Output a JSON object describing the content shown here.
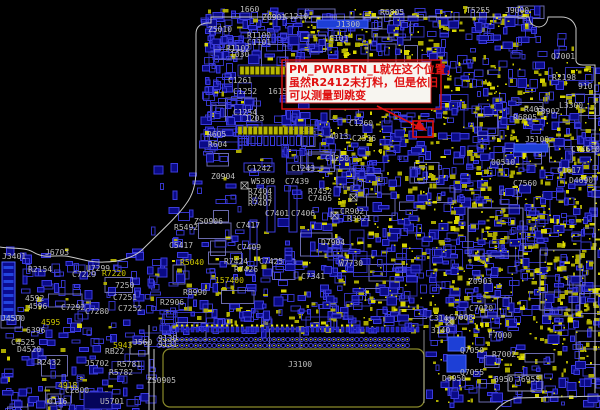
{
  "view": {
    "type": "pcb-boardview",
    "width": 600,
    "height": 410
  },
  "palette": {
    "background": "#000000",
    "blue_outline": "#3b3bdc",
    "blue_fill": "#0a0a85",
    "blue_bright": "#1d3fd6",
    "yellow": "#b9b700",
    "yellow_bright": "#e8e600",
    "label_gray": "#bfbfbf",
    "label_yellow": "#cfc800",
    "board_outline": "#c9c9c9",
    "connector_outline": "#8a8a2a",
    "red": "#e01212",
    "note_bg": "#f7f5f0"
  },
  "annotation": {
    "lines": [
      "PM_PWRBTN_L就在这个位置，",
      "虽然R2412未打料，但是依旧",
      "可以测量到跳变"
    ]
  },
  "labels": [
    {
      "t": "1660",
      "x": 240,
      "y": 12,
      "c": "g"
    },
    {
      "t": "Z0901",
      "x": 262,
      "y": 20,
      "c": "g"
    },
    {
      "t": "C1210",
      "x": 284,
      "y": 19,
      "c": "g"
    },
    {
      "t": "J1300",
      "x": 336,
      "y": 27,
      "c": "g"
    },
    {
      "t": "Z5010",
      "x": 208,
      "y": 32,
      "c": "g"
    },
    {
      "t": "R1100",
      "x": 247,
      "y": 38,
      "c": "g"
    },
    {
      "t": "C1101",
      "x": 247,
      "y": 45,
      "c": "g"
    },
    {
      "t": "R1102",
      "x": 226,
      "y": 51,
      "c": "g"
    },
    {
      "t": "C101",
      "x": 329,
      "y": 41,
      "c": "g"
    },
    {
      "t": "1030",
      "x": 230,
      "y": 57,
      "c": "g"
    },
    {
      "t": "C1261",
      "x": 228,
      "y": 83,
      "c": "g"
    },
    {
      "t": "C1252",
      "x": 233,
      "y": 94,
      "c": "g"
    },
    {
      "t": "1615",
      "x": 268,
      "y": 94,
      "c": "g"
    },
    {
      "t": "C1254",
      "x": 233,
      "y": 115,
      "c": "g"
    },
    {
      "t": "1203",
      "x": 245,
      "y": 121,
      "c": "g"
    },
    {
      "t": "R605",
      "x": 207,
      "y": 137,
      "c": "g"
    },
    {
      "t": "R604",
      "x": 208,
      "y": 147,
      "c": "g"
    },
    {
      "t": "Z0904",
      "x": 211,
      "y": 179,
      "c": "g"
    },
    {
      "t": "C1242",
      "x": 247,
      "y": 171,
      "c": "g"
    },
    {
      "t": "C1243",
      "x": 291,
      "y": 171,
      "c": "g"
    },
    {
      "t": "W5309",
      "x": 251,
      "y": 184,
      "c": "g"
    },
    {
      "t": "C7439",
      "x": 285,
      "y": 184,
      "c": "g"
    },
    {
      "t": "R7404",
      "x": 248,
      "y": 194,
      "c": "g"
    },
    {
      "t": "R7403",
      "x": 248,
      "y": 200,
      "c": "g"
    },
    {
      "t": "R7407",
      "x": 248,
      "y": 206,
      "c": "g"
    },
    {
      "t": "R7452",
      "x": 308,
      "y": 194,
      "c": "g"
    },
    {
      "t": "C7405",
      "x": 308,
      "y": 201,
      "c": "g"
    },
    {
      "t": "C7401",
      "x": 265,
      "y": 216,
      "c": "g"
    },
    {
      "t": "C7406",
      "x": 291,
      "y": 216,
      "c": "g"
    },
    {
      "t": "CR902",
      "x": 340,
      "y": 214,
      "c": "g"
    },
    {
      "t": "R3921",
      "x": 347,
      "y": 221,
      "c": "g"
    },
    {
      "t": "ZS0906",
      "x": 194,
      "y": 224,
      "c": "g"
    },
    {
      "t": "R5492",
      "x": 174,
      "y": 230,
      "c": "g"
    },
    {
      "t": "C5417",
      "x": 169,
      "y": 248,
      "c": "g"
    },
    {
      "t": "C7417",
      "x": 236,
      "y": 228,
      "c": "g"
    },
    {
      "t": "C7409",
      "x": 237,
      "y": 250,
      "c": "g"
    },
    {
      "t": "R7424",
      "x": 224,
      "y": 264,
      "c": "g"
    },
    {
      "t": "C7425",
      "x": 259,
      "y": 264,
      "c": "g"
    },
    {
      "t": "R7426",
      "x": 234,
      "y": 272,
      "c": "g"
    },
    {
      "t": "C7341",
      "x": 301,
      "y": 279,
      "c": "g"
    },
    {
      "t": "R8990",
      "x": 183,
      "y": 295,
      "c": "g"
    },
    {
      "t": "R2906",
      "x": 160,
      "y": 305,
      "c": "g"
    },
    {
      "t": "C7292",
      "x": 61,
      "y": 310,
      "c": "g"
    },
    {
      "t": "C7280",
      "x": 85,
      "y": 314,
      "c": "g"
    },
    {
      "t": "C7251",
      "x": 113,
      "y": 300,
      "c": "g"
    },
    {
      "t": "C7252",
      "x": 118,
      "y": 311,
      "c": "g"
    },
    {
      "t": "7250",
      "x": 115,
      "y": 288,
      "c": "g"
    },
    {
      "t": "U7299",
      "x": 86,
      "y": 271,
      "c": "g"
    },
    {
      "t": "C7229",
      "x": 72,
      "y": 277,
      "c": "g"
    },
    {
      "t": "R2154",
      "x": 28,
      "y": 272,
      "c": "g"
    },
    {
      "t": "J6703",
      "x": 45,
      "y": 255,
      "c": "g"
    },
    {
      "t": "J3401",
      "x": 2,
      "y": 259,
      "c": "g"
    },
    {
      "t": "J4500",
      "x": 1,
      "y": 321,
      "c": "g"
    },
    {
      "t": "4592",
      "x": 25,
      "y": 301,
      "c": "g"
    },
    {
      "t": "4596",
      "x": 28,
      "y": 309,
      "c": "g"
    },
    {
      "t": "D4520",
      "x": 17,
      "y": 352,
      "c": "g"
    },
    {
      "t": "C4525",
      "x": 11,
      "y": 345,
      "c": "g"
    },
    {
      "t": "6396",
      "x": 26,
      "y": 333,
      "c": "g"
    },
    {
      "t": "R2432",
      "x": 37,
      "y": 365,
      "c": "g"
    },
    {
      "t": "J5702",
      "x": 85,
      "y": 366,
      "c": "g"
    },
    {
      "t": "R5781",
      "x": 117,
      "y": 367,
      "c": "g"
    },
    {
      "t": "R5782",
      "x": 109,
      "y": 375,
      "c": "g"
    },
    {
      "t": "RB22",
      "x": 105,
      "y": 354,
      "c": "g"
    },
    {
      "t": "C2800",
      "x": 65,
      "y": 393,
      "c": "g"
    },
    {
      "t": "U5701",
      "x": 100,
      "y": 404,
      "c": "g"
    },
    {
      "t": "0116",
      "x": 48,
      "y": 404,
      "c": "g"
    },
    {
      "t": "ZS0905",
      "x": 147,
      "y": 383,
      "c": "g"
    },
    {
      "t": "J560",
      "x": 133,
      "y": 345,
      "c": "g"
    },
    {
      "t": "9130",
      "x": 158,
      "y": 341,
      "c": "g"
    },
    {
      "t": "9131",
      "x": 158,
      "y": 347,
      "c": "g"
    },
    {
      "t": "J3100",
      "x": 288,
      "y": 367,
      "c": "g"
    },
    {
      "t": "Z0903",
      "x": 468,
      "y": 284,
      "c": "g"
    },
    {
      "t": "C7020",
      "x": 469,
      "y": 311,
      "c": "g"
    },
    {
      "t": "C7008",
      "x": 449,
      "y": 320,
      "c": "g"
    },
    {
      "t": "C314",
      "x": 429,
      "y": 321,
      "c": "g"
    },
    {
      "t": "3140",
      "x": 431,
      "y": 333,
      "c": "g"
    },
    {
      "t": "F7000",
      "x": 488,
      "y": 338,
      "c": "g"
    },
    {
      "t": "Q7050",
      "x": 460,
      "y": 353,
      "c": "g"
    },
    {
      "t": "R7002",
      "x": 492,
      "y": 357,
      "c": "g"
    },
    {
      "t": "Q7055",
      "x": 460,
      "y": 375,
      "c": "g"
    },
    {
      "t": "D6950",
      "x": 442,
      "y": 381,
      "c": "g"
    },
    {
      "t": "6950",
      "x": 494,
      "y": 382,
      "c": "g"
    },
    {
      "t": "J6955",
      "x": 516,
      "y": 382,
      "c": "g"
    },
    {
      "t": "D7904",
      "x": 321,
      "y": 245,
      "c": "g"
    },
    {
      "t": "W7730",
      "x": 339,
      "y": 266,
      "c": "g"
    },
    {
      "t": "C7560",
      "x": 513,
      "y": 186,
      "c": "g"
    },
    {
      "t": "D4690",
      "x": 569,
      "y": 183,
      "c": "g"
    },
    {
      "t": "C1617",
      "x": 557,
      "y": 173,
      "c": "g"
    },
    {
      "t": "00510",
      "x": 491,
      "y": 165,
      "c": "g"
    },
    {
      "t": "CY4610",
      "x": 571,
      "y": 152,
      "c": "g"
    },
    {
      "t": "J5100",
      "x": 525,
      "y": 142,
      "c": "g"
    },
    {
      "t": "T3902",
      "x": 536,
      "y": 114,
      "c": "g"
    },
    {
      "t": "R403",
      "x": 524,
      "y": 112,
      "c": "g"
    },
    {
      "t": "L3300",
      "x": 559,
      "y": 108,
      "c": "g"
    },
    {
      "t": "R6805",
      "x": 513,
      "y": 120,
      "c": "g"
    },
    {
      "t": "R2198",
      "x": 552,
      "y": 80,
      "c": "g"
    },
    {
      "t": "910",
      "x": 578,
      "y": 89,
      "c": "g"
    },
    {
      "t": "Q7001",
      "x": 551,
      "y": 59,
      "c": "g"
    },
    {
      "t": "J9000",
      "x": 505,
      "y": 13,
      "c": "g"
    },
    {
      "t": "T5255",
      "x": 466,
      "y": 13,
      "c": "g"
    },
    {
      "t": "R6805",
      "x": 380,
      "y": 15,
      "c": "g"
    },
    {
      "t": "C1260",
      "x": 349,
      "y": 126,
      "c": "g"
    },
    {
      "t": "C1250",
      "x": 325,
      "y": 161,
      "c": "g"
    },
    {
      "t": "4013",
      "x": 329,
      "y": 139,
      "c": "g"
    },
    {
      "t": "C2536",
      "x": 352,
      "y": 141,
      "c": "g"
    },
    {
      "t": "R5040",
      "x": 180,
      "y": 265,
      "c": "y"
    },
    {
      "t": "R7220",
      "x": 102,
      "y": 276,
      "c": "y"
    },
    {
      "t": "157400",
      "x": 215,
      "y": 283,
      "c": "y"
    },
    {
      "t": "4595",
      "x": 41,
      "y": 325,
      "c": "y"
    },
    {
      "t": "4918",
      "x": 58,
      "y": 388,
      "c": "y"
    },
    {
      "t": "5943",
      "x": 113,
      "y": 348,
      "c": "y"
    }
  ]
}
